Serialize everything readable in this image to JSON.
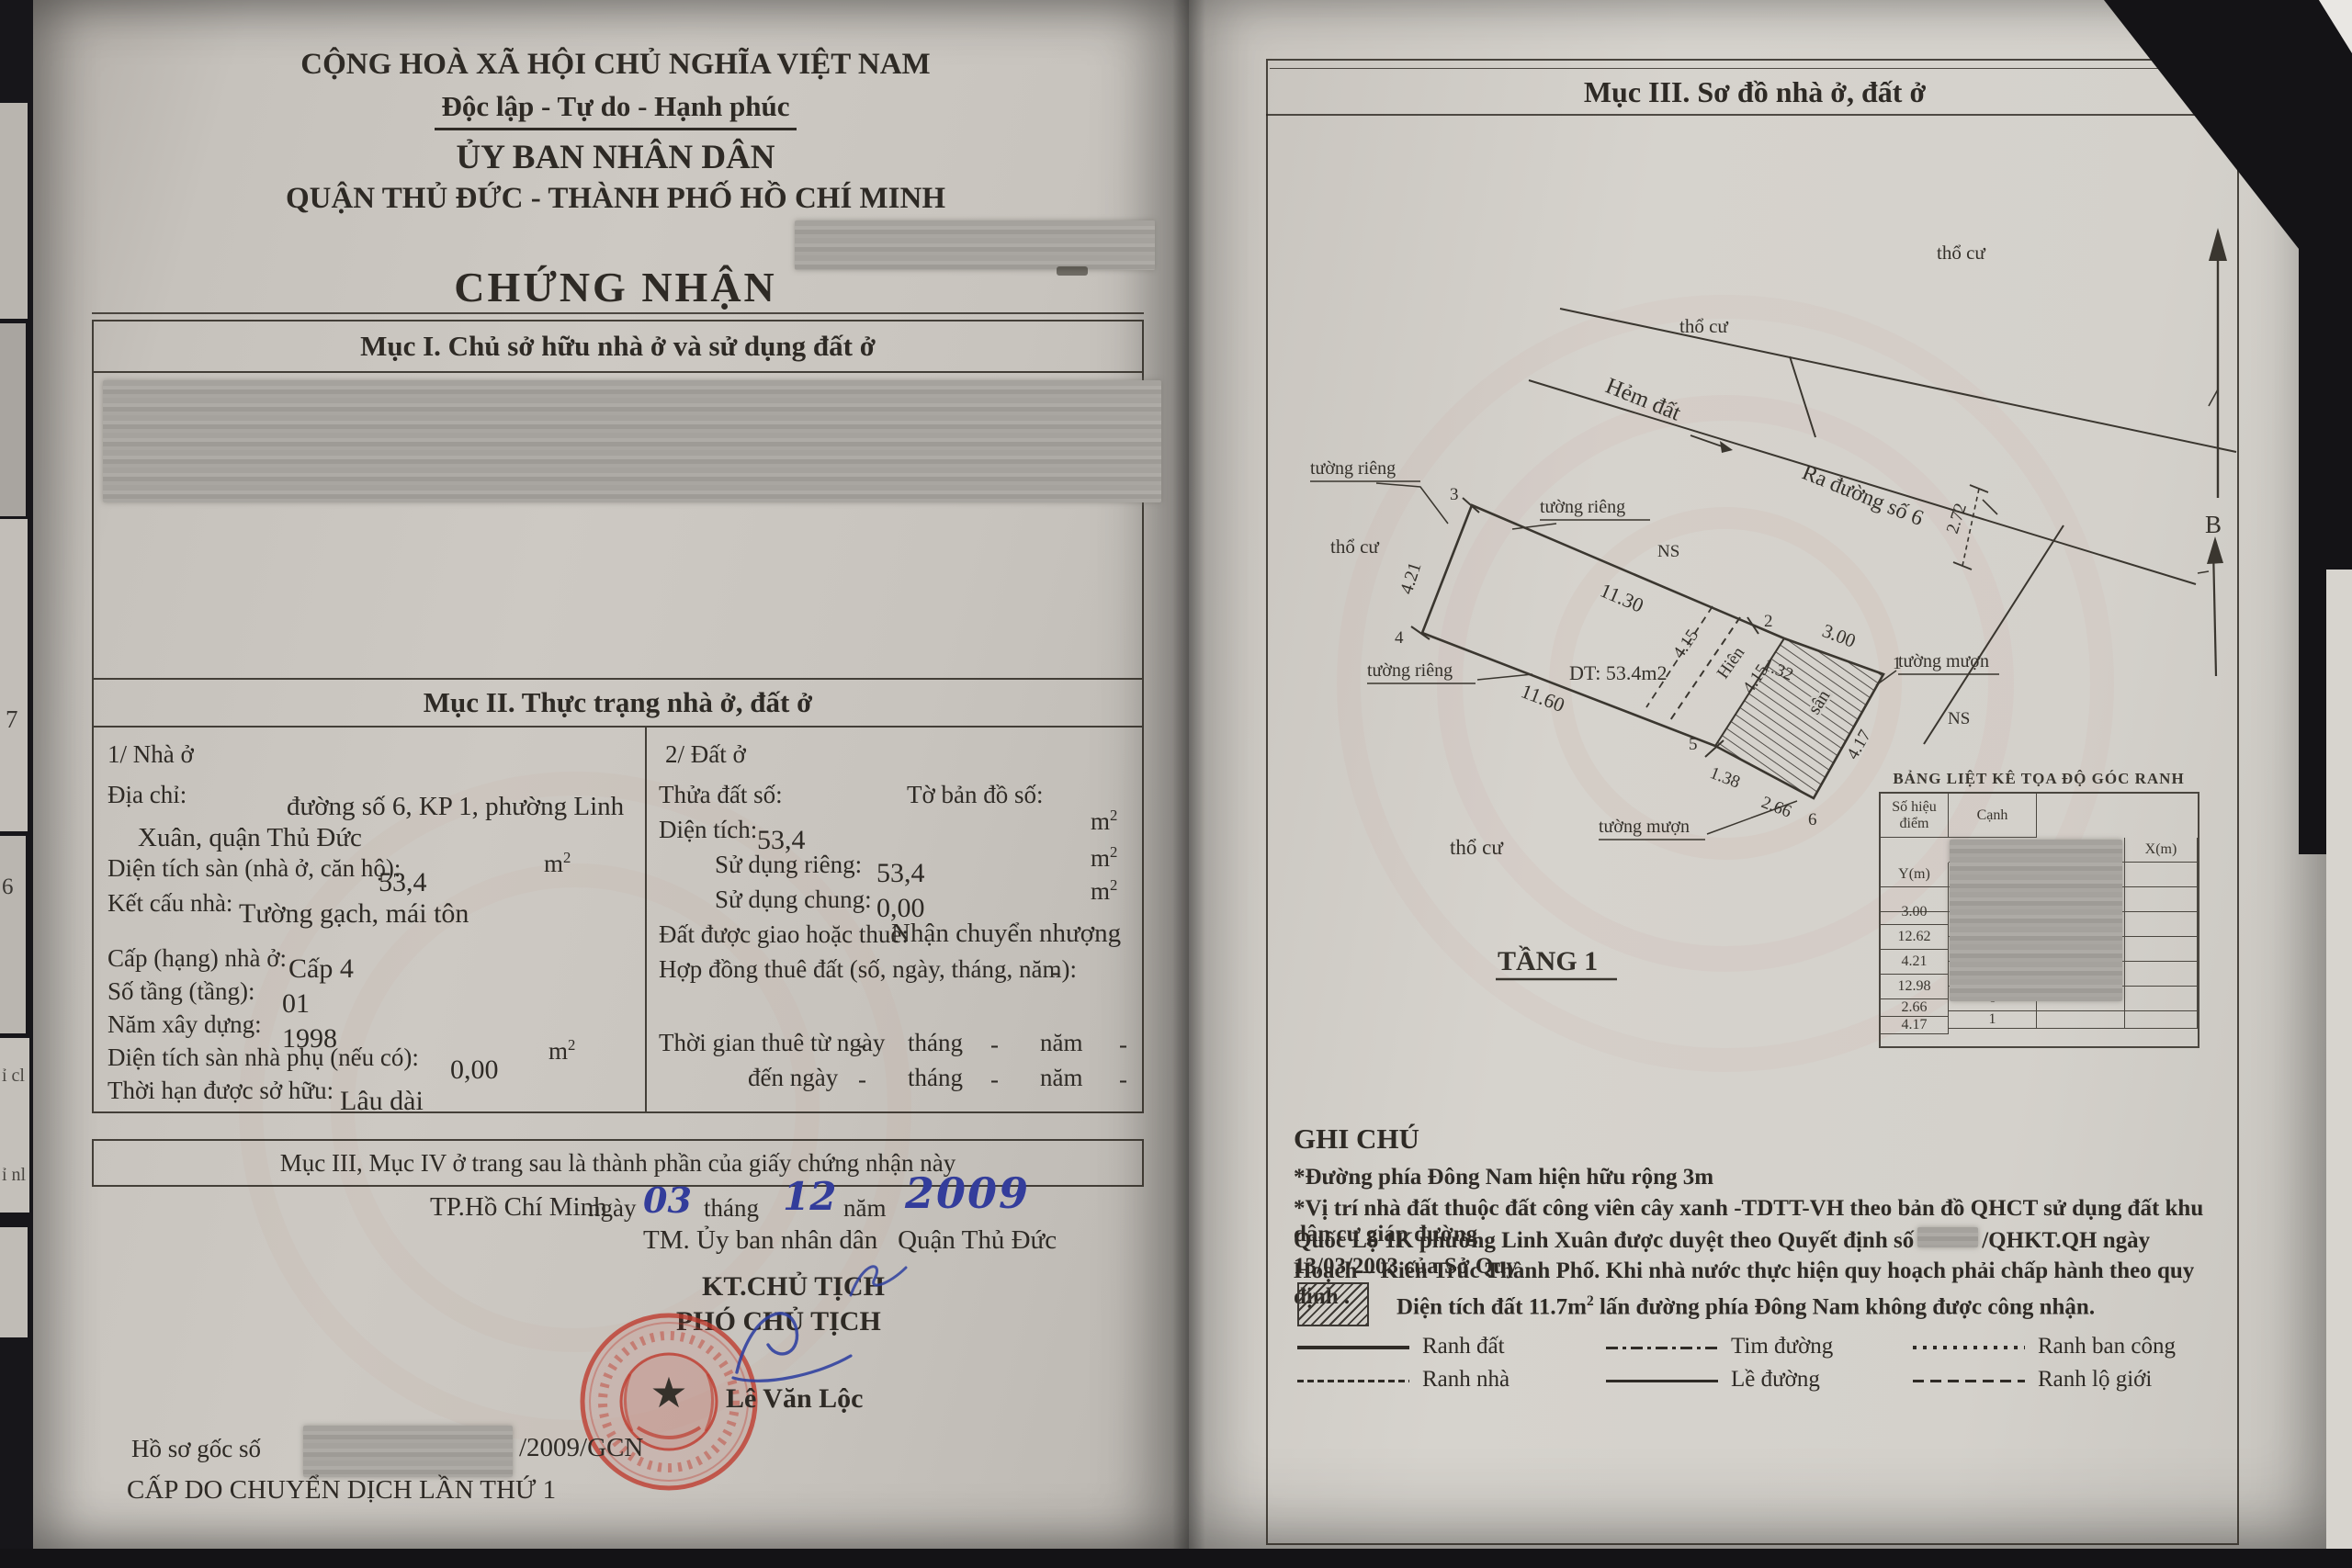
{
  "units": {
    "m": "m",
    "sup2": "2"
  },
  "left_page": {
    "header": {
      "line1": "CỘNG HOÀ XÃ HỘI CHỦ NGHĨA VIỆT NAM",
      "line2": "Độc lập - Tự do - Hạnh phúc",
      "line3": "ỦY BAN NHÂN DÂN",
      "line4": "QUẬN THỦ ĐỨC - THÀNH PHỐ HỒ CHÍ MINH",
      "title": "CHỨNG NHẬN"
    },
    "section1_title": "Mục I. Chủ sở hữu nhà ở và sử dụng đất ở",
    "section2": {
      "title": "Mục II. Thực trạng nhà ở, đất ở",
      "house": {
        "heading": "1/ Nhà ở",
        "address_label": "Địa chỉ:",
        "address_value_line1": "đường số 6, KP 1, phường Linh",
        "address_value_line2": "Xuân, quận Thủ Đức",
        "floor_area_label": "Diện tích sàn (nhà ở, căn hộ):",
        "floor_area_value": "53,4",
        "structure_label": "Kết cấu nhà:",
        "structure_value": "Tường gạch, mái tôn",
        "grade_label": "Cấp (hạng) nhà ở:",
        "grade_value": "Cấp 4",
        "floors_label": "Số tầng (tầng):",
        "floors_value": "01",
        "year_label": "Năm xây dựng:",
        "year_value": "1998",
        "aux_area_label": "Diện tích sàn nhà phụ (nếu có):",
        "aux_area_value": "0,00",
        "tenure_label": "Thời hạn được sở hữu:",
        "tenure_value": "Lâu dài"
      },
      "land": {
        "heading": "2/ Đất ở",
        "plot_label": "Thửa đất số:",
        "map_label": "Tờ bản đồ số:",
        "area_label": "Diện tích:",
        "area_value": "53,4",
        "private_label": "Sử dụng riêng:",
        "private_value": "53,4",
        "shared_label": "Sử dụng chung:",
        "shared_value": "0,00",
        "assign_label": "Đất được giao hoặc thuê:",
        "assign_value": "Nhận chuyển nhượng",
        "lease_label": "Hợp đồng thuê đất (số, ngày, tháng, năm):",
        "lease_value": "-",
        "lease_from_label": "Thời gian thuê từ ngày",
        "lease_to_label": "đến ngày",
        "thang": "tháng",
        "nam": "năm",
        "dash": "-"
      }
    },
    "note_row": "Mục III, Mục IV ở trang sau là thành phần của giấy chứng nhận này",
    "issue": {
      "place": "TP.Hồ Chí Minh",
      "ngay": "ngày",
      "day": "03",
      "thang": "tháng",
      "month": "12",
      "nam": "năm",
      "year": "2009",
      "tm_line_a": "TM. Ủy ban nhân dân",
      "tm_line_b": "Quận Thủ Đức",
      "kt": "KT.CHỦ TỊCH",
      "pho": "PHÓ CHỦ TỊCH",
      "signer": "Lê Văn Lộc"
    },
    "footer": {
      "rec_label": "Hồ sơ gốc số",
      "rec_number": "/2009/GCN",
      "line2": "CẤP DO CHUYỂN DỊCH LẦN THỨ 1"
    }
  },
  "right_page": {
    "title": "Mục III. Sơ đồ nhà ở, đất ở",
    "plan": {
      "tho_cu_top": "thổ cư",
      "tho_cu_right": "thổ cư",
      "tho_cu_left": "thổ cư",
      "tho_cu_bottom": "thổ cư",
      "hem": "Hẻm đất",
      "ra_duong": "Ra đường số 6",
      "ns_a": "NS",
      "ns_b": "NS",
      "tuong_rieng_1": "tường riêng",
      "tuong_rieng_2": "tường riêng",
      "tuong_rieng_3": "tường riêng",
      "tuong_muon_1": "tường mượn",
      "tuong_muon_2": "tường mượn",
      "area": "DT: 53.4m2",
      "hien": "Hiên",
      "san": "sân",
      "floor": "TẦNG 1",
      "north": "B",
      "dims": {
        "left": "4.21",
        "top": "11.30",
        "top2": "1.32",
        "road": "3.00",
        "bottom": "11.60",
        "b2": "1.38",
        "b3": "2.66",
        "right": "4.17",
        "gap": "2.72",
        "h1": "4.15",
        "h2": "4.15"
      },
      "points": {
        "p1": "1",
        "p2": "2",
        "p3": "3",
        "p4": "4",
        "p5": "5",
        "p6": "6"
      }
    },
    "coords_table": {
      "title": "BẢNG LIỆT KÊ TỌA ĐỘ GÓC RANH",
      "col_point_a": "Số hiệu",
      "col_point_b": "điểm",
      "col_coord": "Tọa độ",
      "col_x": "X(m)",
      "col_y": "Y(m)",
      "col_edge": "Cạnh",
      "rows": [
        {
          "point": "1",
          "edge": ""
        },
        {
          "point": "2",
          "edge": "3.00"
        },
        {
          "point": "3",
          "edge": "12.62"
        },
        {
          "point": "4",
          "edge": "4.21"
        },
        {
          "point": "5",
          "edge": "12.98"
        },
        {
          "point": "6",
          "edge": "2.66"
        },
        {
          "point": "1",
          "edge": "4.17"
        }
      ]
    },
    "notes": {
      "title": "GHI CHÚ",
      "line1": "*Đường phía Đông Nam hiện hữu rộng 3m",
      "line2": "*Vị trí nhà đất thuộc đất công viên cây xanh -TDTT-VH theo bản đồ QHCT sử dụng đất khu dân cư giáp đường",
      "line3a": "Quốc Lộ 1K phường Linh Xuân được duyệt theo Quyết định số",
      "line3b": "/QHKT.QH ngày 13/03/2003 của Sở Quy",
      "line4": "Hoạch – Kiến Trúc Thành Phố. Khi nhà nước thực hiện quy hoạch phải chấp hành theo quy định .",
      "hatch_note_a": "Diện tích đất 11.7m",
      "hatch_note_b": " lấn đường phía Đông Nam không được công nhận."
    },
    "legend": {
      "items": [
        {
          "label": "Ranh đất",
          "style": "solid-thick"
        },
        {
          "label": "Tim đường",
          "style": "dashdot"
        },
        {
          "label": "Ranh ban công",
          "style": "dotted"
        },
        {
          "label": "Ranh nhà",
          "style": "dash-fine"
        },
        {
          "label": "Lề đường",
          "style": "solid-thin"
        },
        {
          "label": "Ranh lộ giới",
          "style": "dash"
        }
      ]
    }
  },
  "marginalia": {
    "d7": "7",
    "d6": "6",
    "t1": "ỉ cl",
    "t2": "ỉ nl"
  }
}
